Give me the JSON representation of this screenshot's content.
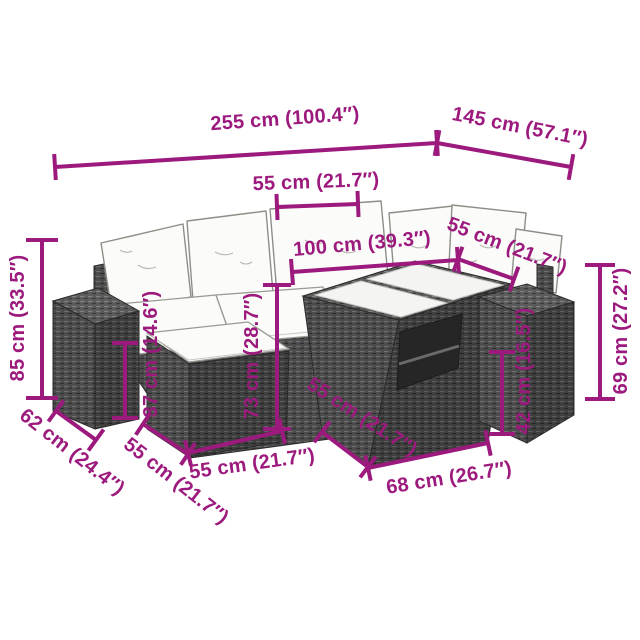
{
  "diagram": {
    "kind": "product-dimensions",
    "subject": "7-piece poly rattan garden lounge set with cushions",
    "colors": {
      "accent": "#9c1a7d",
      "background": "#ffffff",
      "rattan": "#4c4c4c",
      "rattan_light": "#5b5b5b",
      "rattan_dark": "#3e3e3e",
      "cushion": "#fbfbf9",
      "glass": "#f4f4f2"
    }
  },
  "dims": {
    "total_width": {
      "label": "255 cm (100.4″)"
    },
    "total_depth": {
      "label": "145 cm (57.1″)"
    },
    "seat_width": {
      "label": "55 cm (21.7″)"
    },
    "corner_width": {
      "label": "100 cm (39.3″)"
    },
    "corner_seat_width": {
      "label": "55 cm (21.7″)"
    },
    "total_height": {
      "label": "85 cm (33.5″)"
    },
    "seat_height": {
      "label": "37 cm (14.6″)"
    },
    "backrest_height": {
      "label": "73 cm (28.7″)"
    },
    "table_height": {
      "label": "42 cm (16.5″)"
    },
    "side_table_height": {
      "label": "69 cm (27.2″)"
    },
    "side_table_depth": {
      "label": "62 cm (24.4″)"
    },
    "footstool_depth": {
      "label": "55 cm (21.7″)"
    },
    "footstool_width": {
      "label": "55 cm (21.7″)"
    },
    "table_depth": {
      "label": "55 cm (21.7″)"
    },
    "table_width": {
      "label": "68 cm (26.7″)"
    }
  }
}
